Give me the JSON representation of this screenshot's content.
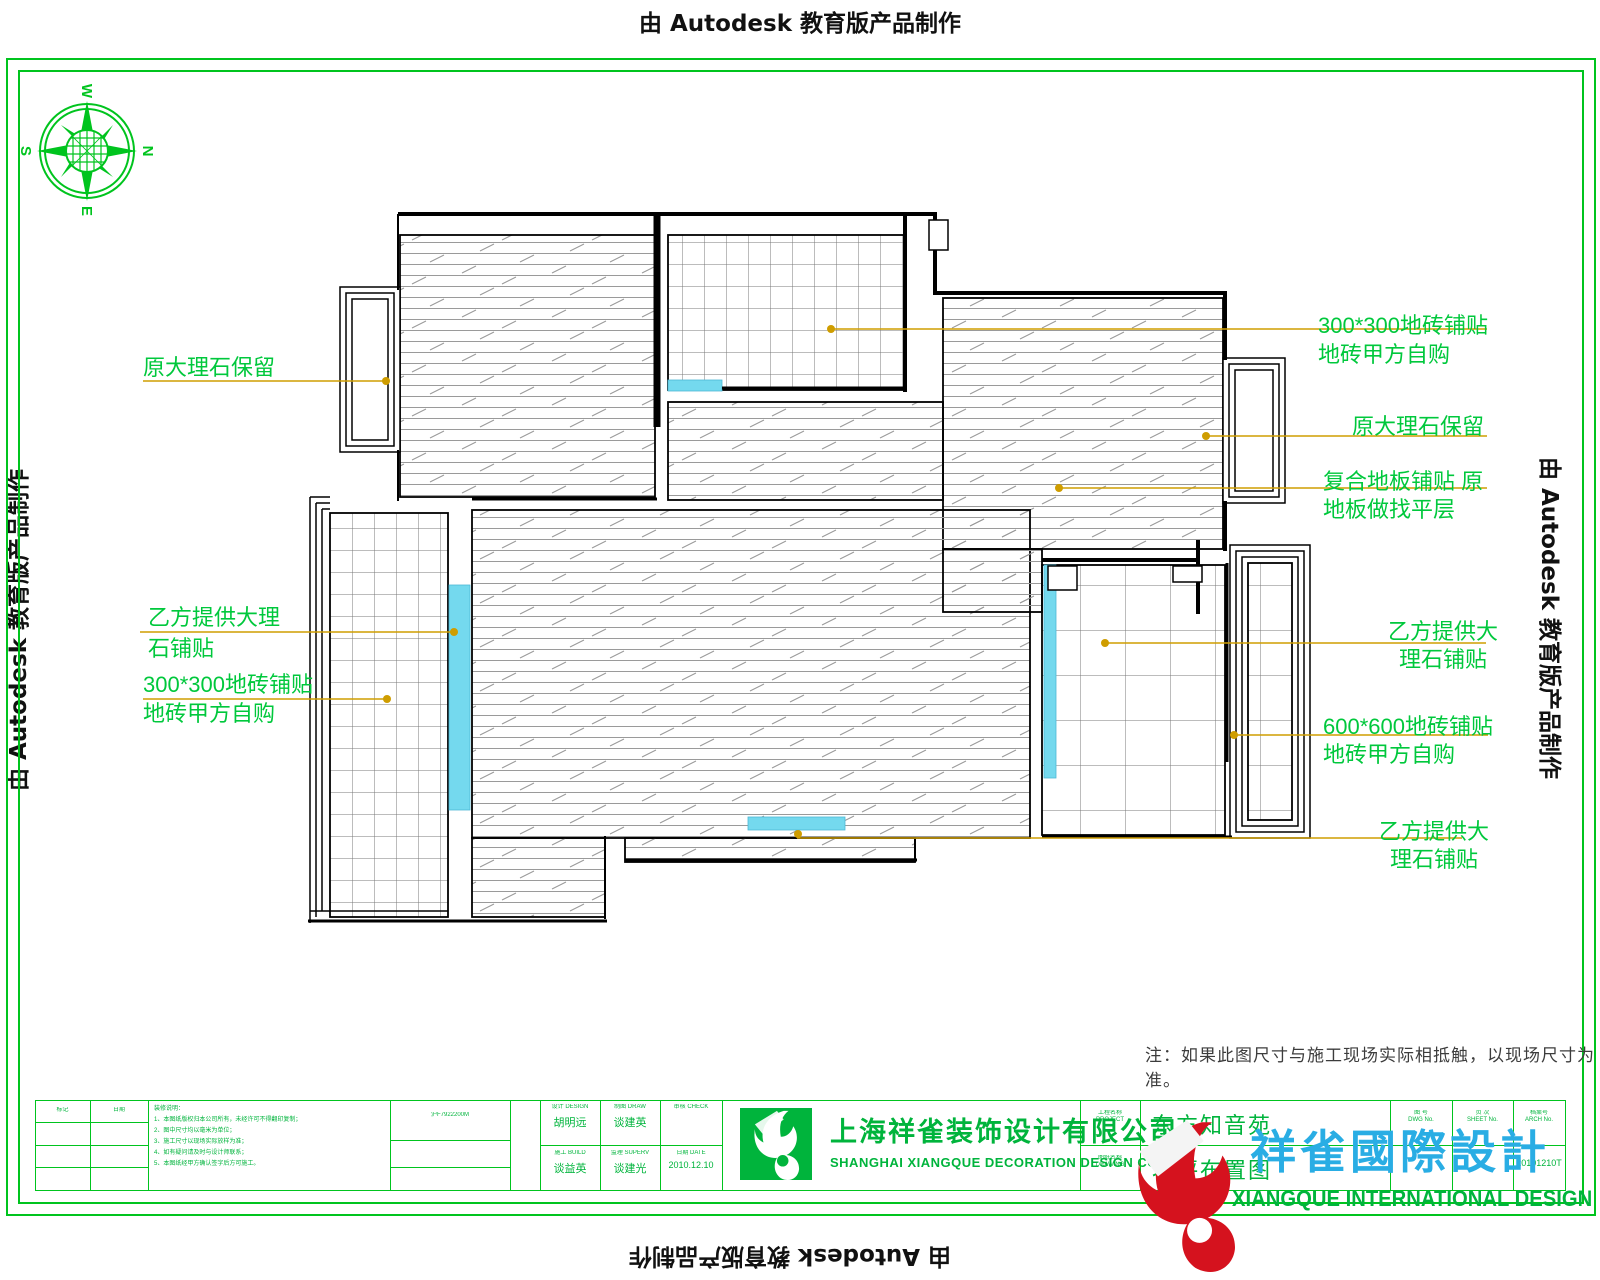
{
  "watermark": {
    "text": "由 Autodesk 教育版产品制作"
  },
  "compass": {
    "n": "N",
    "e": "E",
    "s": "S",
    "w": "W"
  },
  "annotations": {
    "left": [
      {
        "line1": "原大理石保留",
        "line2": ""
      },
      {
        "line1": "乙方提供大理",
        "line2": "石铺贴"
      },
      {
        "line1": "300*300地砖铺贴",
        "line2": "地砖甲方自购"
      }
    ],
    "right": [
      {
        "line1": "300*300地砖铺贴",
        "line2": "地砖甲方自购"
      },
      {
        "line1": "原大理石保留",
        "line2": ""
      },
      {
        "line1": "复合地板铺贴 原",
        "line2": "地板做找平层"
      },
      {
        "line1": "乙方提供大",
        "line2": "理石铺贴"
      },
      {
        "line1": "600*600地砖铺贴",
        "line2": "地砖甲方自购"
      },
      {
        "line1": "乙方提供大",
        "line2": "理石铺贴"
      }
    ]
  },
  "note": "注：如果此图尺寸与施工现场实际相抵触，以现场尺寸为准。",
  "title_block": {
    "rev": {
      "col1": "标记",
      "col2": "日期"
    },
    "notes": {
      "lines": [
        "装修说明：",
        "1、本图纸版权归本公司所有，未经许可不得翻印复制；",
        "2、图中尺寸均以毫米为单位；",
        "3、施工尺寸以现场实际放样为准；",
        "4、如有疑问请及时与设计师联系；",
        "5、本图纸经甲方确认签字后方可施工。"
      ]
    },
    "cert_no": "沪F7922200M",
    "personnel": [
      {
        "role": "设计 DESIGN",
        "name": "胡明远"
      },
      {
        "role": "制图 DRAW",
        "name": "谈建英"
      },
      {
        "role": "审核 CHECK",
        "name": ""
      },
      {
        "role": "施工 BUILD",
        "name": "谈益英"
      },
      {
        "role": "监理 SUPERV",
        "name": "谈建光"
      },
      {
        "role": "日期 DATE",
        "name": "2010.12.10"
      }
    ],
    "company": {
      "cn": "上海祥雀装饰设计有限公司",
      "en": "SHANGHAI XIANGQUE DECORATION DESIGN CO.LTD"
    },
    "project": {
      "label_cn": "工程名称",
      "label_en": "PROJECT",
      "value": "东方知音苑"
    },
    "drawing": {
      "label_cn": "图纸名称",
      "label_en": "DRAWING",
      "value": "地坪布置图"
    },
    "numbers": [
      {
        "label_cn": "图 号",
        "label_en": "DWG No.",
        "value": ""
      },
      {
        "label_cn": "页 次",
        "label_en": "SHEET No.",
        "value": ""
      },
      {
        "label_cn": "档案号",
        "label_en": "ARCH No.",
        "value": "20101210T"
      }
    ]
  },
  "logo": {
    "cn": "祥雀國際設計",
    "en": "XIANGQUE INTERNATIONAL DESIGN"
  },
  "colors": {
    "frame_green": "#00c41e",
    "label_green": "#00c83c",
    "leader_orange": "#cf9d00",
    "threshold_cyan": "#74d9ee",
    "logo_red": "#d5121e",
    "logo_blue": "#29ade4",
    "logo_green": "#00b43c"
  }
}
